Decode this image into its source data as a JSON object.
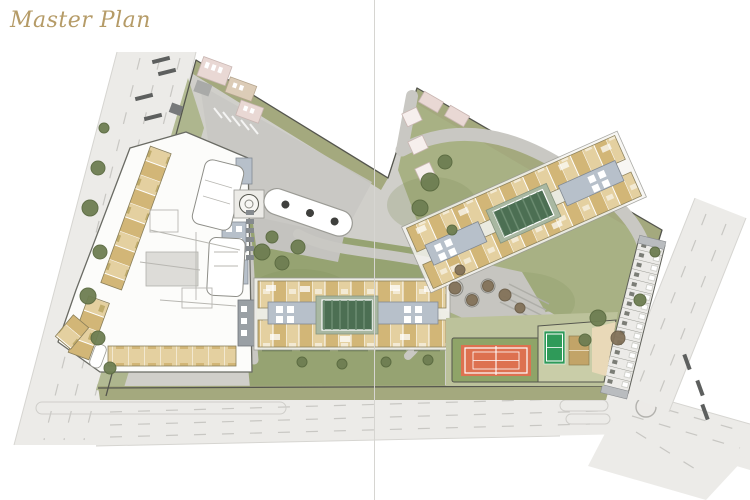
{
  "page": {
    "title": "Master Plan"
  },
  "palette": {
    "bg": "#ffffff",
    "title_gold": "#b59b67",
    "divider": "#d6d5d1",
    "road_fill": "#ecebe8",
    "road_edge": "#d6d5d1",
    "lane_dash": "#c8c7c3",
    "crosswalk": "#5d5f5e",
    "ground_gray": "#d0cfca",
    "plaza_gray": "#c6c5c0",
    "path_gray": "#c9c8c3",
    "lawn": "#a8b184",
    "lawn_dark": "#96a372",
    "lawn_pale": "#bcc29b",
    "olive_strip": "#a4a97e",
    "outline": "#55564e",
    "bldg_white": "#fcfcfa",
    "bldg_stroke": "#6a6b64",
    "unit_tan": "#e4d0a0",
    "unit_tan2": "#d2b677",
    "unit_dark": "#9c8836",
    "core_gray": "#b7c0ca",
    "core_stroke": "#828a93",
    "core_window": "#ffffff",
    "pool": "#4c6f53",
    "pool_lane": "#6e8e73",
    "pool_deck": "#a9b8a2",
    "pink": "#e9d8d4",
    "pink_light": "#f6efed",
    "pink_stroke": "#c9b6b2",
    "court_orange": "#dd7150",
    "court_green": "#2f9a59",
    "court_tan": "#c2a468",
    "sand": "#e9d9b8",
    "tree": "#6e7e52",
    "tree_dark": "#5a6a40",
    "tree_brown": "#837259"
  },
  "plan": {
    "features": [
      "perimeter-road-west",
      "perimeter-road-south",
      "perimeter-road-east",
      "site-ground",
      "main-building-complex",
      "drop-off-canopy",
      "central-apartment-block",
      "central-pool",
      "north-apartment-block",
      "north-pool",
      "row-building-strip",
      "tennis-court",
      "sports-court",
      "sand-court",
      "central-plaza",
      "roundabout",
      "landscape-trees",
      "context-buildings-pink"
    ]
  }
}
